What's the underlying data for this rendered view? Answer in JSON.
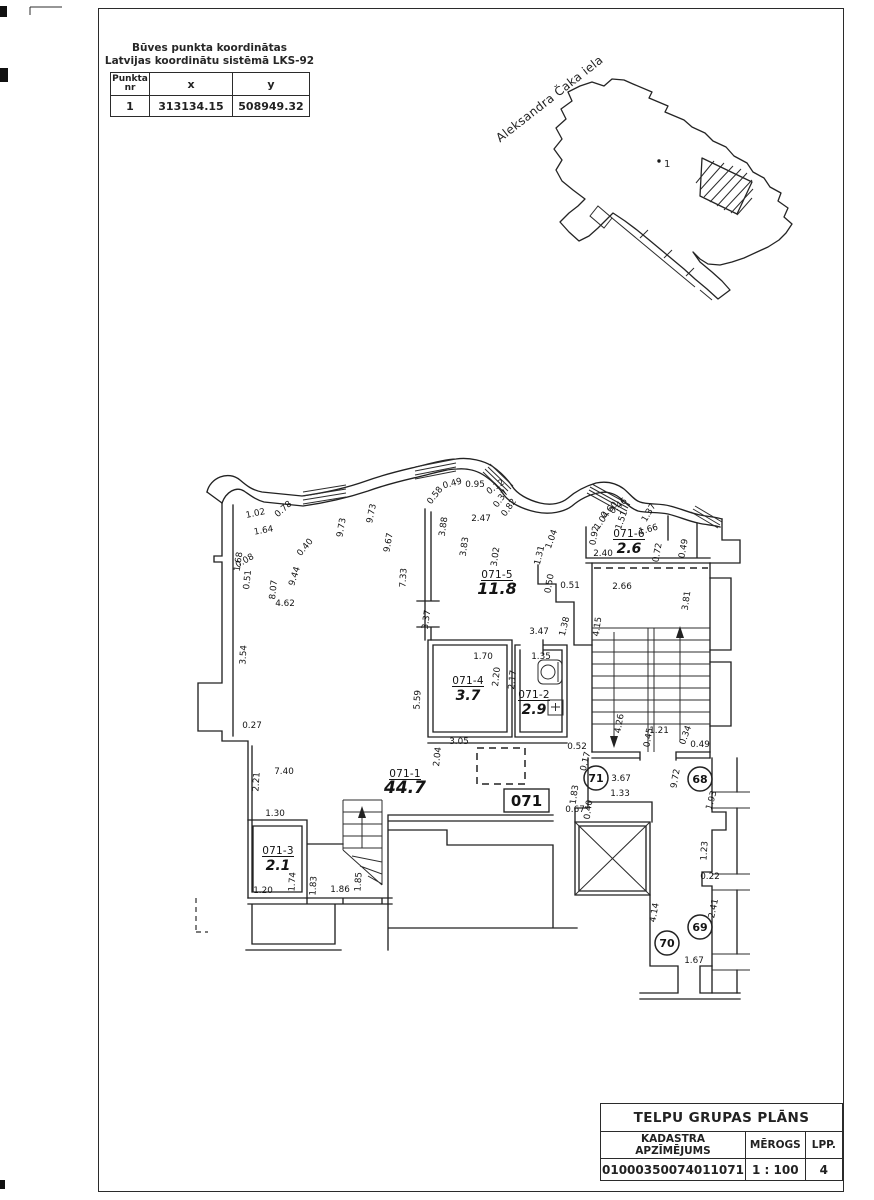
{
  "coord_table": {
    "title_line1": "Būves punkta koordinātas",
    "title_line2": "Latvijas koordinātu sistēmā LKS-92",
    "col_point_line1": "Punkta",
    "col_point_line2": "nr",
    "col_x": "x",
    "col_y": "y",
    "row": {
      "nr": "1",
      "x": "313134.15",
      "y": "508949.32"
    }
  },
  "site_plan": {
    "street_label": "Aleksandra Čaka iela",
    "point_label": "1"
  },
  "title_block": {
    "title": "TELPU GRUPAS PLĀNS",
    "col1_label": "KADASTRA APZĪMĒJUMS",
    "col2_label": "MĒROGS",
    "col3_label": "LPP.",
    "cadastre_number": "01000350074011071",
    "scale_value": "1 : 100",
    "page_value": "4"
  },
  "plan": {
    "group_box_label": "071",
    "rooms": [
      {
        "id": "071-5",
        "area": "11.8",
        "x": 497,
        "y": 578,
        "s": 16
      },
      {
        "id": "071-6",
        "area": "2.6",
        "x": 629,
        "y": 537,
        "s": 14
      },
      {
        "id": "071-4",
        "area": "3.7",
        "x": 468,
        "y": 684,
        "s": 14
      },
      {
        "id": "071-2",
        "area": "2.9",
        "x": 534,
        "y": 698,
        "s": 14
      },
      {
        "id": "071-1",
        "area": "44.7",
        "x": 405,
        "y": 777,
        "s": 17
      },
      {
        "id": "071-3",
        "area": "2.1",
        "x": 278,
        "y": 854,
        "s": 14
      }
    ],
    "circle_marks": [
      {
        "n": "71",
        "x": 596,
        "y": 778
      },
      {
        "n": "68",
        "x": 700,
        "y": 779
      },
      {
        "n": "69",
        "x": 700,
        "y": 927
      },
      {
        "n": "70",
        "x": 667,
        "y": 943
      }
    ],
    "dimensions": [
      {
        "t": "1.02",
        "x": 256,
        "y": 516,
        "r": -12
      },
      {
        "t": "0.78",
        "x": 285,
        "y": 511,
        "r": -42
      },
      {
        "t": "1.64",
        "x": 264,
        "y": 533,
        "r": -10
      },
      {
        "t": "1.68",
        "x": 241,
        "y": 562,
        "r": -82
      },
      {
        "t": "8.07",
        "x": 276,
        "y": 590,
        "r": -84
      },
      {
        "t": "9.44",
        "x": 297,
        "y": 577,
        "r": -72
      },
      {
        "t": "0.40",
        "x": 307,
        "y": 549,
        "r": -50
      },
      {
        "t": "9.73",
        "x": 344,
        "y": 528,
        "r": -80
      },
      {
        "t": "9.73",
        "x": 374,
        "y": 514,
        "r": -78
      },
      {
        "t": "9.67",
        "x": 391,
        "y": 543,
        "r": -80
      },
      {
        "t": "7.33",
        "x": 406,
        "y": 578,
        "r": -86
      },
      {
        "t": "0.08",
        "x": 246,
        "y": 563,
        "r": -30
      },
      {
        "t": "0.51",
        "x": 250,
        "y": 580,
        "r": -84
      },
      {
        "t": "3.54",
        "x": 246,
        "y": 655,
        "r": -86
      },
      {
        "t": "4.62",
        "x": 285,
        "y": 606,
        "r": 0
      },
      {
        "t": "0.27",
        "x": 252,
        "y": 728,
        "r": 0
      },
      {
        "t": "2.21",
        "x": 259,
        "y": 782,
        "r": -86
      },
      {
        "t": "7.40",
        "x": 284,
        "y": 774,
        "r": 0
      },
      {
        "t": "1.30",
        "x": 275,
        "y": 816,
        "r": 0
      },
      {
        "t": "1.20",
        "x": 263,
        "y": 893,
        "r": 0
      },
      {
        "t": "1.74",
        "x": 295,
        "y": 882,
        "r": -86
      },
      {
        "t": "1.83",
        "x": 316,
        "y": 886,
        "r": -86
      },
      {
        "t": "1.86",
        "x": 340,
        "y": 892,
        "r": 0
      },
      {
        "t": "1.85",
        "x": 361,
        "y": 882,
        "r": -86
      },
      {
        "t": "0.58",
        "x": 437,
        "y": 497,
        "r": -52
      },
      {
        "t": "0.49",
        "x": 453,
        "y": 486,
        "r": -15
      },
      {
        "t": "0.95",
        "x": 475,
        "y": 487,
        "r": 0
      },
      {
        "t": "0.12",
        "x": 497,
        "y": 489,
        "r": -35
      },
      {
        "t": "0.37",
        "x": 503,
        "y": 500,
        "r": -55
      },
      {
        "t": "0.82",
        "x": 511,
        "y": 509,
        "r": -55
      },
      {
        "t": "3.88",
        "x": 446,
        "y": 527,
        "r": -82
      },
      {
        "t": "2.47",
        "x": 481,
        "y": 521,
        "r": 0
      },
      {
        "t": "3.83",
        "x": 467,
        "y": 547,
        "r": -82
      },
      {
        "t": "3.02",
        "x": 498,
        "y": 557,
        "r": -82
      },
      {
        "t": "1.04",
        "x": 554,
        "y": 540,
        "r": -70
      },
      {
        "t": "1.31",
        "x": 542,
        "y": 556,
        "r": -76
      },
      {
        "t": "0.92",
        "x": 597,
        "y": 536,
        "r": -80
      },
      {
        "t": "1.04",
        "x": 604,
        "y": 522,
        "r": -55
      },
      {
        "t": "0.60",
        "x": 611,
        "y": 512,
        "r": -45
      },
      {
        "t": "0.46",
        "x": 620,
        "y": 508,
        "r": -40
      },
      {
        "t": "1.51",
        "x": 624,
        "y": 521,
        "r": -70
      },
      {
        "t": "1.37",
        "x": 651,
        "y": 514,
        "r": -60
      },
      {
        "t": "1.66",
        "x": 649,
        "y": 532,
        "r": -15
      },
      {
        "t": "2.40",
        "x": 603,
        "y": 556,
        "r": 0
      },
      {
        "t": "0.72",
        "x": 660,
        "y": 553,
        "r": -80
      },
      {
        "t": "0.49",
        "x": 686,
        "y": 549,
        "r": -80
      },
      {
        "t": "0.50",
        "x": 552,
        "y": 584,
        "r": -80
      },
      {
        "t": "0.51",
        "x": 570,
        "y": 588,
        "r": 0
      },
      {
        "t": "2.66",
        "x": 622,
        "y": 589,
        "r": 0
      },
      {
        "t": "4.15",
        "x": 600,
        "y": 627,
        "r": -82
      },
      {
        "t": "3.81",
        "x": 689,
        "y": 601,
        "r": -82
      },
      {
        "t": "1.38",
        "x": 567,
        "y": 627,
        "r": -76
      },
      {
        "t": "3.37",
        "x": 429,
        "y": 620,
        "r": -82
      },
      {
        "t": "3.47",
        "x": 539,
        "y": 634,
        "r": 0
      },
      {
        "t": "1.70",
        "x": 483,
        "y": 659,
        "r": 0
      },
      {
        "t": "1.35",
        "x": 541,
        "y": 659,
        "r": 0
      },
      {
        "t": "2.20",
        "x": 499,
        "y": 677,
        "r": -84
      },
      {
        "t": "2.17",
        "x": 515,
        "y": 680,
        "r": -84
      },
      {
        "t": "5.59",
        "x": 420,
        "y": 700,
        "r": -86
      },
      {
        "t": "4.26",
        "x": 622,
        "y": 724,
        "r": -80
      },
      {
        "t": "0.45",
        "x": 651,
        "y": 738,
        "r": -80
      },
      {
        "t": "1.21",
        "x": 659,
        "y": 733,
        "r": 0
      },
      {
        "t": "0.34",
        "x": 688,
        "y": 736,
        "r": -70
      },
      {
        "t": "0.49",
        "x": 700,
        "y": 747,
        "r": 0
      },
      {
        "t": "3.05",
        "x": 459,
        "y": 744,
        "r": 0
      },
      {
        "t": "2.04",
        "x": 440,
        "y": 757,
        "r": -84
      },
      {
        "t": "0.52",
        "x": 577,
        "y": 749,
        "r": 0
      },
      {
        "t": "0.17",
        "x": 588,
        "y": 762,
        "r": -76
      },
      {
        "t": "1.83",
        "x": 577,
        "y": 795,
        "r": -82
      },
      {
        "t": "0.67",
        "x": 575,
        "y": 812,
        "r": 0
      },
      {
        "t": "0.40",
        "x": 591,
        "y": 810,
        "r": -82
      },
      {
        "t": "3.67",
        "x": 621,
        "y": 781,
        "r": 0
      },
      {
        "t": "1.33",
        "x": 620,
        "y": 796,
        "r": 0
      },
      {
        "t": "9.72",
        "x": 678,
        "y": 779,
        "r": -80
      },
      {
        "t": "1.93",
        "x": 714,
        "y": 801,
        "r": -74
      },
      {
        "t": "1.23",
        "x": 707,
        "y": 851,
        "r": -86
      },
      {
        "t": "0.22",
        "x": 710,
        "y": 879,
        "r": 0
      },
      {
        "t": "2.41",
        "x": 716,
        "y": 909,
        "r": -78
      },
      {
        "t": "4.14",
        "x": 657,
        "y": 913,
        "r": -80
      },
      {
        "t": "1.67",
        "x": 694,
        "y": 963,
        "r": 0
      }
    ]
  }
}
